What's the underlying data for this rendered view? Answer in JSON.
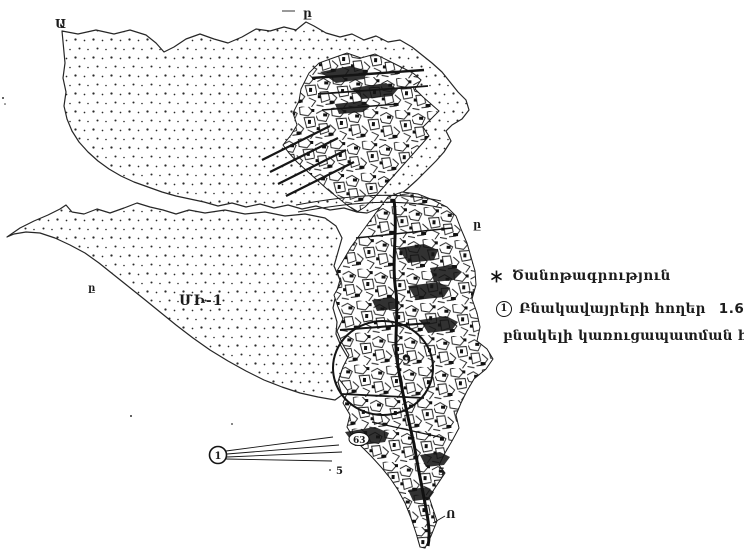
{
  "document": {
    "kind": "scanned cadastral land-use map",
    "paper_color": "#ffffff",
    "ink_color": "#1c1c1c",
    "zone_label_color": "#8c8c8c"
  },
  "legend": {
    "note": {
      "marker_icon": "asterisk",
      "label": "Ծանոթագրություն"
    },
    "item": {
      "marker": "1",
      "text": "Բնակավայրերի հողեր",
      "value": "1.6764 հա",
      "suffix": "-",
      "line2": "բնակելի կառուցապատման համար"
    }
  },
  "map": {
    "labels": {
      "top_left": "Ա",
      "top_center": "ը",
      "right_edge": "ը",
      "southwest_edge": "ը",
      "zone": "ՄԻ-1",
      "ellipse_zone": "19",
      "block_63": "63",
      "block_5_left": "5",
      "block_5_right": "5",
      "block_7": "7",
      "tail": "Ո",
      "callout_number": "1"
    }
  }
}
